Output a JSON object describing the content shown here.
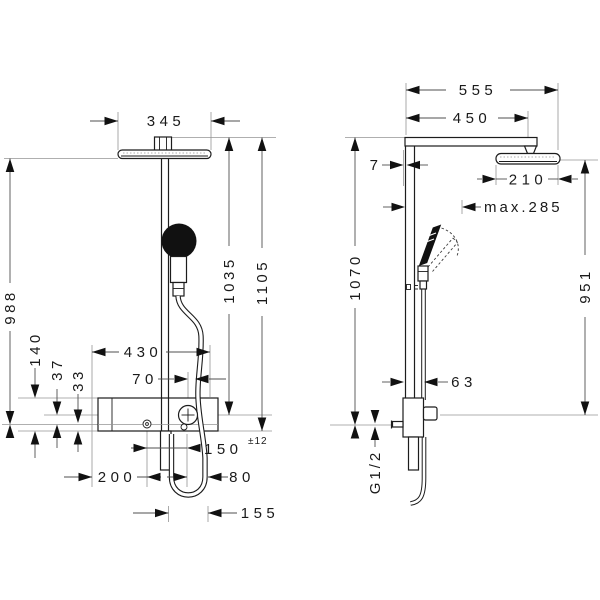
{
  "drawing": {
    "type": "technical dimension drawing, shower pipe system, front and side view",
    "units": "mm",
    "labels": {
      "front": {
        "overhead_width": "345",
        "height_to_connection": "988",
        "valve_height": "140",
        "offset_37": "37",
        "offset_33": "33",
        "height_1035": "1035",
        "total_height": "1105",
        "valve_width": "430",
        "offset_70": "70",
        "connection_spacing": "150",
        "tolerance": "±12",
        "offset_200": "200",
        "offset_80": "80",
        "hose_loop_width": "155"
      },
      "side": {
        "arm_total": "555",
        "arm_reach": "450",
        "wall_gap": "7",
        "head_depth": "210",
        "max_reach": "max.285",
        "height_1070": "1070",
        "height_951": "951",
        "valve_depth": "63",
        "thread": "G1/2"
      }
    },
    "line_colors": {
      "object": "#1c1c1c",
      "reference": "#949494",
      "dimension": "#4f4f4f"
    }
  }
}
